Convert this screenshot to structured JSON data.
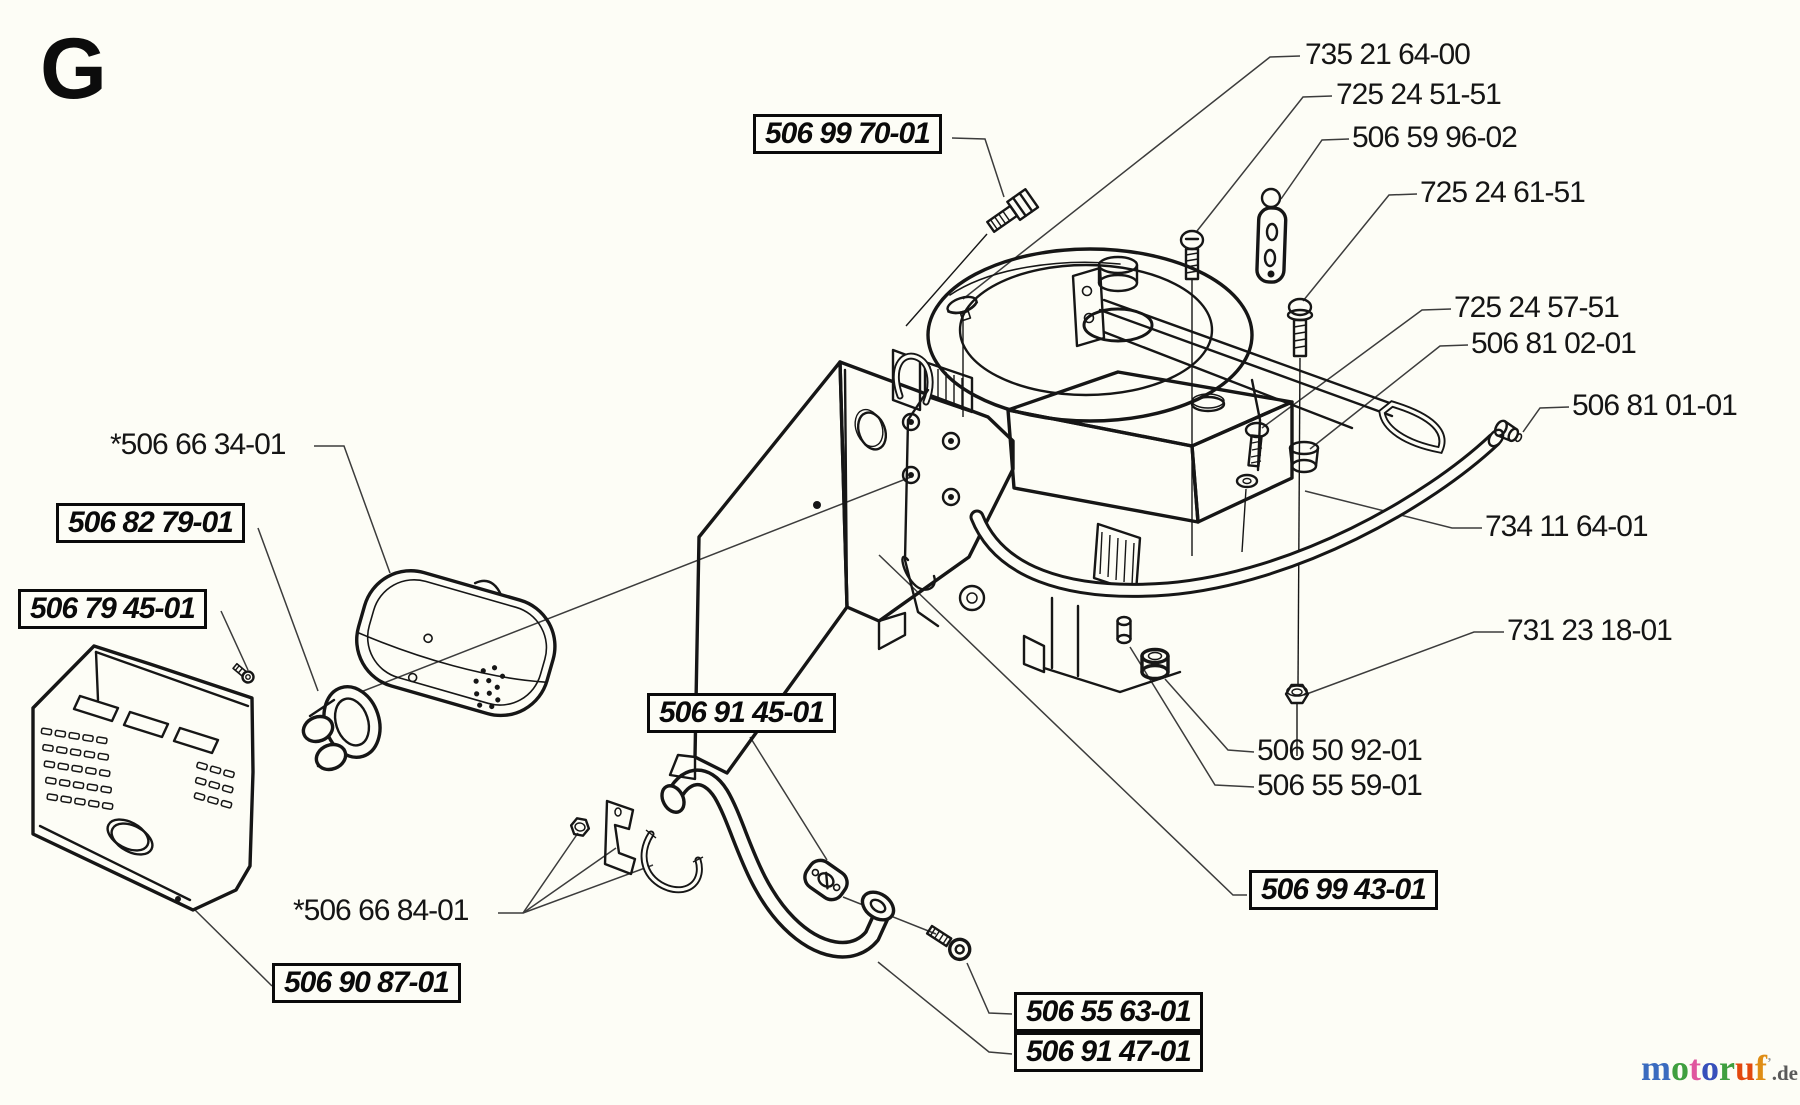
{
  "page": {
    "section_letter": "G",
    "bg_color": "#fdfdf6",
    "ink_color": "#161616",
    "leader_color": "#3c3c3c"
  },
  "labels": {
    "plain": [
      {
        "part_no": "735 21 64-00"
      },
      {
        "part_no": "725 24 51-51"
      },
      {
        "part_no": "506 59 96-02"
      },
      {
        "part_no": "725 24 61-51"
      },
      {
        "part_no": "725 24 57-51"
      },
      {
        "part_no": "506 81 02-01"
      },
      {
        "part_no": "506 81 01-01"
      },
      {
        "part_no": "734 11 64-01"
      },
      {
        "part_no": "731 23 18-01"
      },
      {
        "part_no": "506 50 92-01"
      },
      {
        "part_no": "506 55 59-01"
      },
      {
        "part_no": "*506 66 34-01"
      },
      {
        "part_no": "*506 66 84-01"
      }
    ],
    "boxed": [
      {
        "part_no": "506 99 70-01"
      },
      {
        "part_no": "506 82 79-01"
      },
      {
        "part_no": "506 79 45-01"
      },
      {
        "part_no": "506 90 87-01"
      },
      {
        "part_no": "506 91 45-01"
      },
      {
        "part_no": "506 99 43-01"
      },
      {
        "part_no": "506 55 63-01"
      },
      {
        "part_no": "506 91 47-01"
      }
    ]
  },
  "logo": {
    "letters": [
      {
        "ch": "m",
        "color": "#3a6bbf"
      },
      {
        "ch": "o",
        "color": "#3f9f3f"
      },
      {
        "ch": "t",
        "color": "#e0569f"
      },
      {
        "ch": "o",
        "color": "#3850bb"
      },
      {
        "ch": "r",
        "color": "#3f9f3f"
      },
      {
        "ch": "u",
        "color": "#e3480e"
      },
      {
        "ch": "f",
        "color": "#df8d15"
      }
    ],
    "mark": "’",
    "tld": ".de",
    "tld_color": "#5a5a5a"
  }
}
